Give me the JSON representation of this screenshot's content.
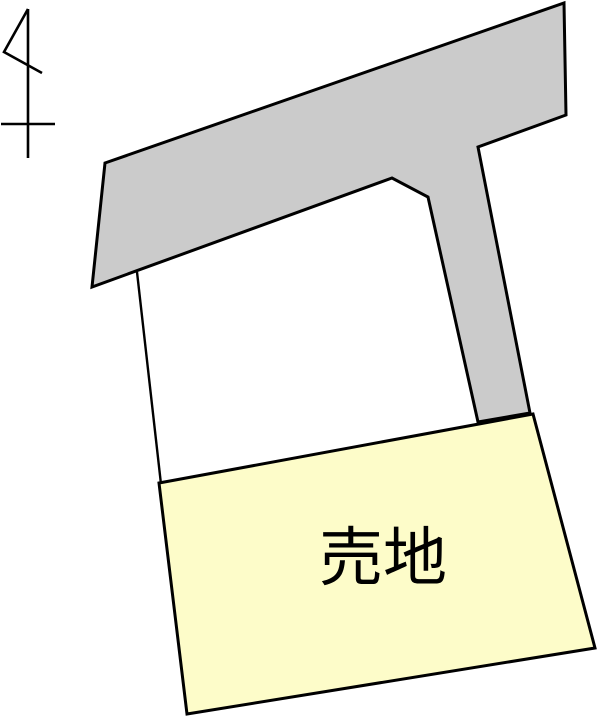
{
  "map": {
    "plot_label": "売地",
    "colors": {
      "road_fill": "#cbcbcb",
      "plot_fill": "#fdfcc9",
      "outline": "#000000",
      "background": "#ffffff"
    },
    "icons": {
      "north_arrow": "north-arrow-icon"
    }
  }
}
